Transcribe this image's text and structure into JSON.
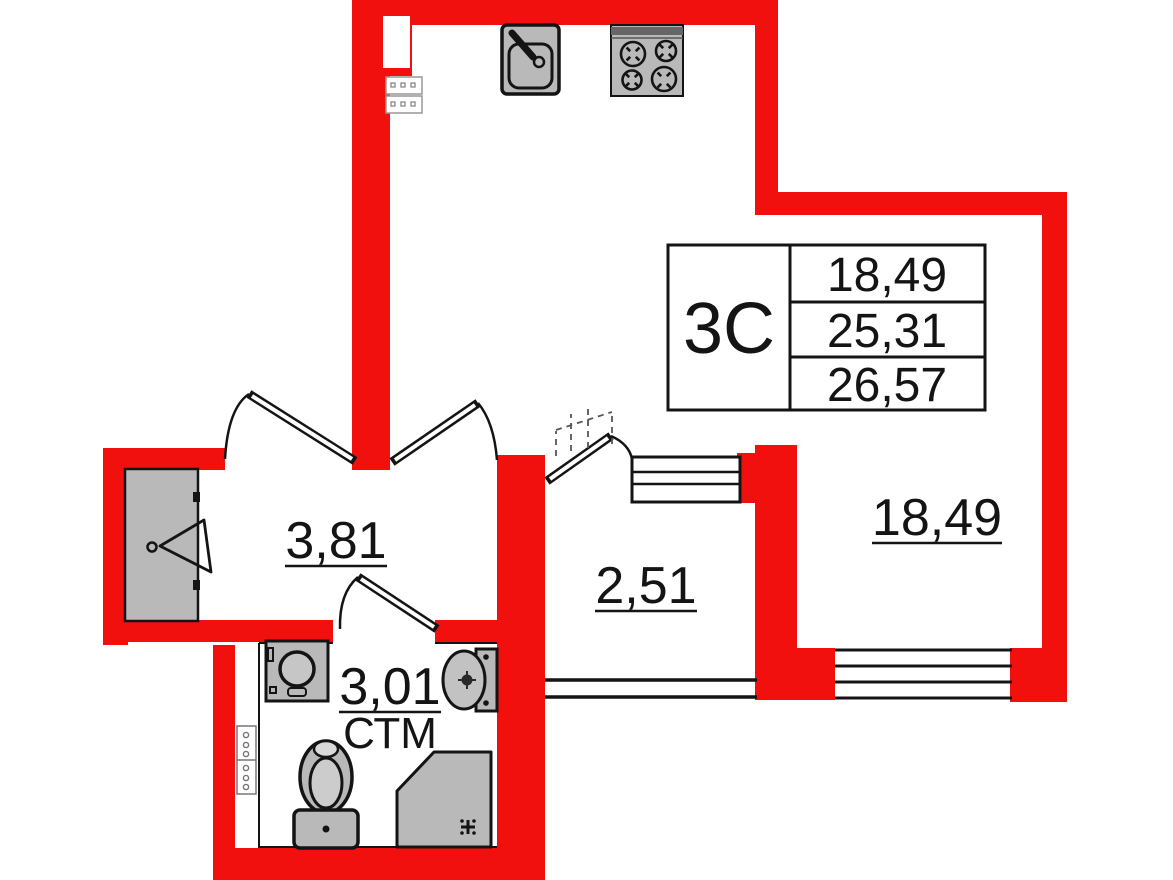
{
  "plan": {
    "title": "apartment-floor-plan",
    "info_table": {
      "type_label": "3С",
      "rows": [
        "18,49",
        "25,31",
        "26,57"
      ]
    },
    "rooms": [
      {
        "id": "hallway",
        "area": "3,81"
      },
      {
        "id": "corridor",
        "area": "2,51"
      },
      {
        "id": "bathroom",
        "area": "3,01",
        "note": "СТМ"
      },
      {
        "id": "living-room",
        "area": "18,49"
      }
    ],
    "fixtures": [
      "kitchen-sink",
      "stove-4-burners",
      "washing-machine",
      "bathroom-sink",
      "toilet",
      "shower-tray",
      "wardrobe-with-hanger",
      "vent-shaft"
    ],
    "colors": {
      "wall": "#f2100e",
      "fixture_fill": "#b9b9b9",
      "line": "#141414",
      "background": "#ffffff"
    }
  }
}
